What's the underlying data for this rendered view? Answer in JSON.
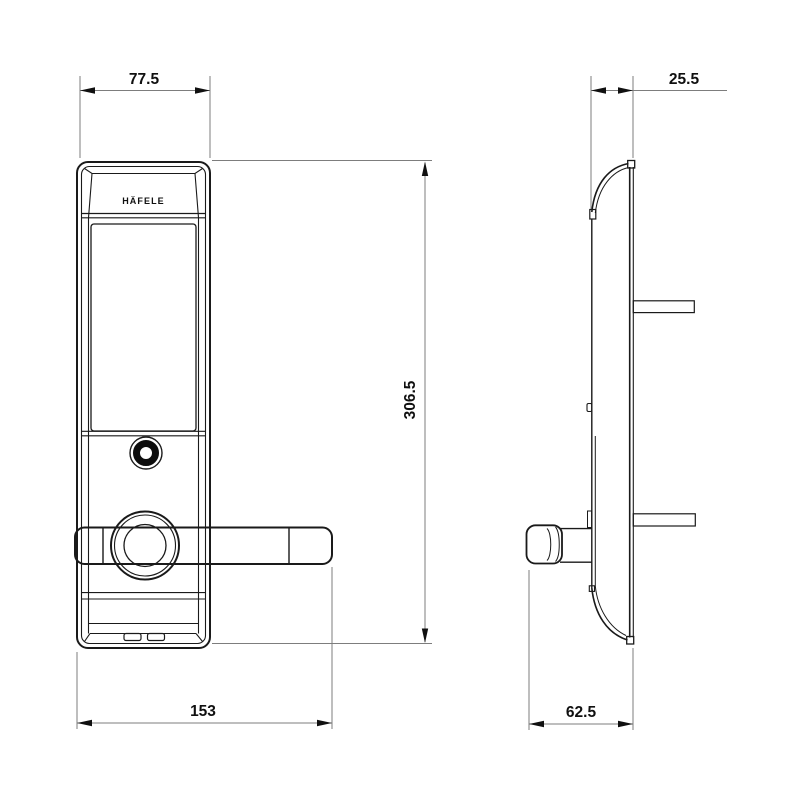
{
  "drawing": {
    "brand_logo": "HÄFELE",
    "dimensions": {
      "front_width_mm": "77.5",
      "overall_height_mm": "306.5",
      "overall_width_mm": "153",
      "side_thickness_mm": "25.5",
      "handle_depth_mm": "62.5"
    },
    "colors": {
      "line": "#1a1a1a",
      "dimension_line": "#7d7d7d",
      "text": "#101010",
      "background": "#ffffff"
    }
  }
}
